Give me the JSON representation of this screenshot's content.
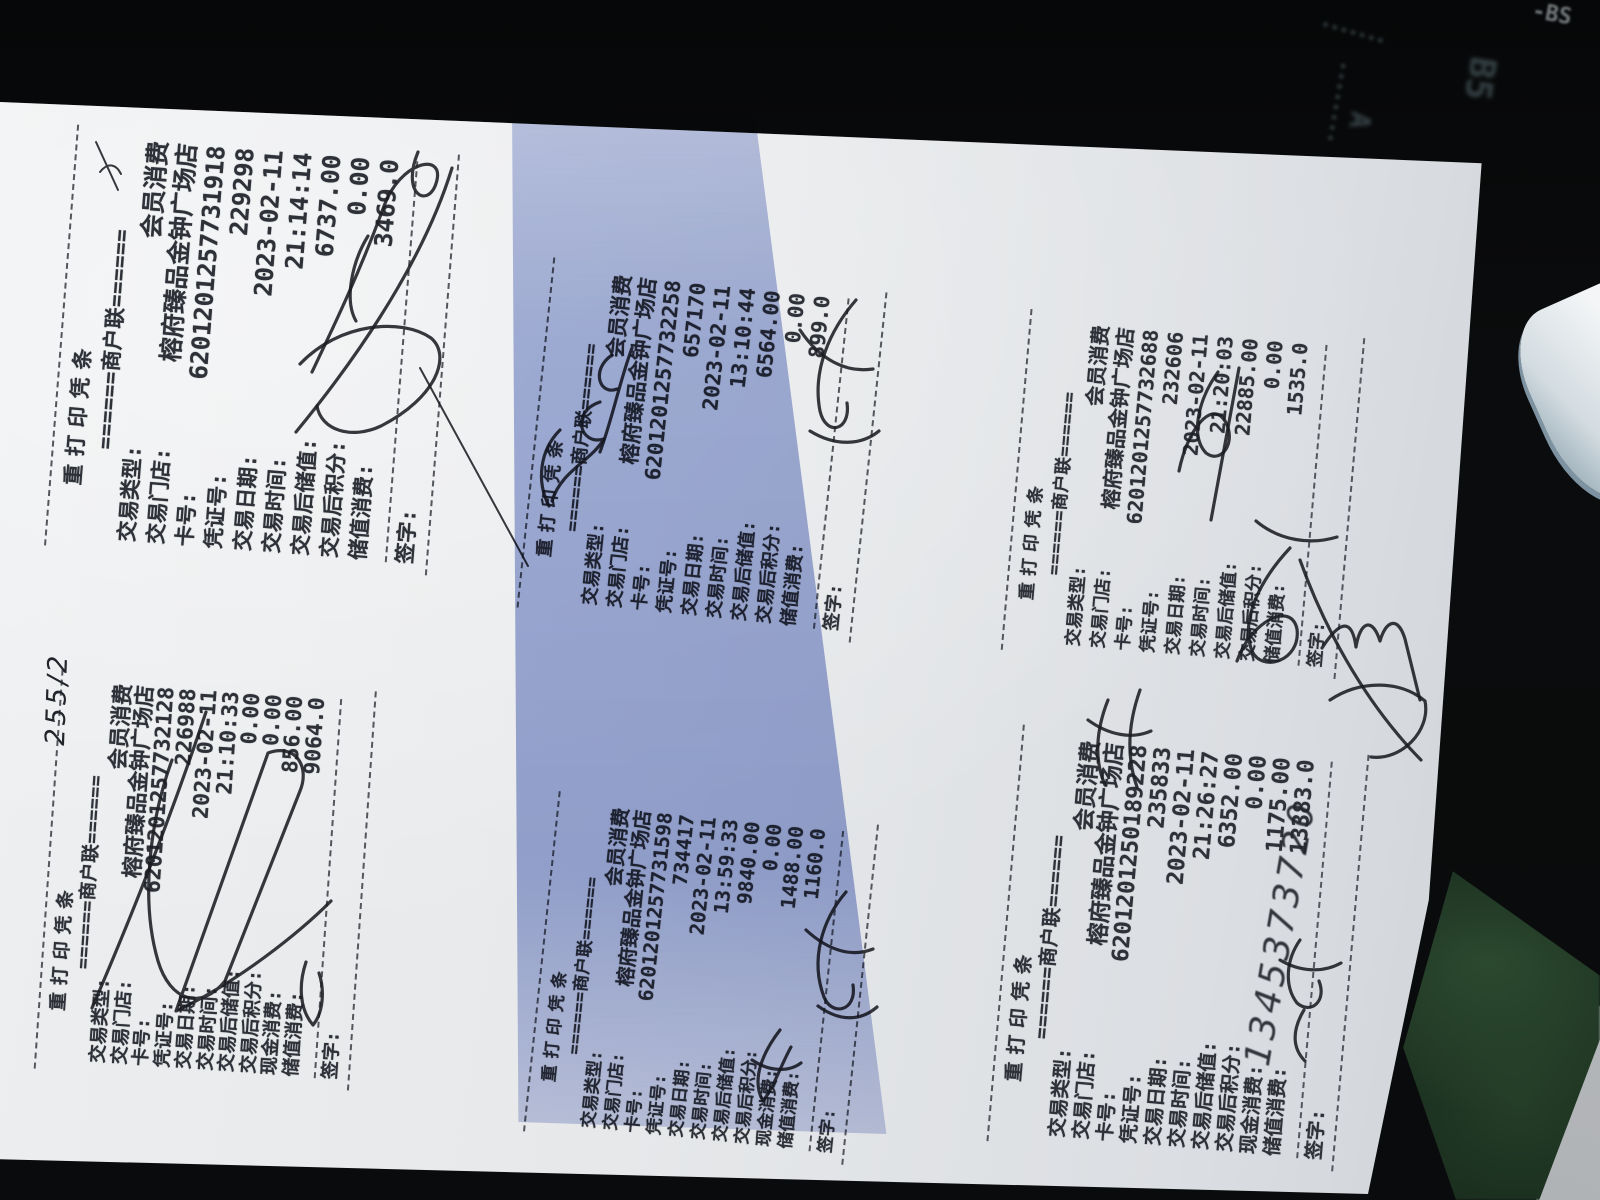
{
  "photo": {
    "background": {
      "mat_color": "#08090a",
      "mat_label_b5": "B5",
      "mat_label_a": "A",
      "mat_label_bs": "-BS",
      "shadow_band_color": "#9dabd8",
      "paper_color": "#e6e8ea"
    }
  },
  "receipt_common": {
    "title": "重打印凭条",
    "copy_line": "======商户联======",
    "sign_label": "签字:"
  },
  "receipts": [
    {
      "id": "top-left",
      "lines": [
        {
          "label": "交易类型:",
          "value": "会员消费"
        },
        {
          "label": "交易门店:",
          "value": "榕府臻品金钟广场店"
        },
        {
          "label": "卡号:",
          "value": "6201201257731918"
        },
        {
          "label": "凭证号:",
          "value": "229298"
        },
        {
          "label": "交易日期:",
          "value": "2023-02-11"
        },
        {
          "label": "交易时间:",
          "value": "21:14:14"
        },
        {
          "label": "交易后储值:",
          "value": "6737.00"
        },
        {
          "label": "交易后积分:",
          "value": "0.00"
        },
        {
          "label": "储值消费:",
          "value": "3469.0"
        }
      ]
    },
    {
      "id": "top-middle",
      "lines": [
        {
          "label": "交易类型:",
          "value": "会员消费"
        },
        {
          "label": "交易门店:",
          "value": "榕府臻品金钟广场店"
        },
        {
          "label": "卡号:",
          "value": "6201201257732258"
        },
        {
          "label": "凭证号:",
          "value": "657170"
        },
        {
          "label": "交易日期:",
          "value": "2023-02-11"
        },
        {
          "label": "交易时间:",
          "value": "13:10:44"
        },
        {
          "label": "交易后储值:",
          "value": "6564.00"
        },
        {
          "label": "交易后积分:",
          "value": "0.00"
        },
        {
          "label": "储值消费:",
          "value": "899.0"
        }
      ]
    },
    {
      "id": "top-right",
      "lines": [
        {
          "label": "交易类型:",
          "value": "会员消费"
        },
        {
          "label": "交易门店:",
          "value": "榕府臻品金钟广场店"
        },
        {
          "label": "卡号:",
          "value": "6201201257732688"
        },
        {
          "label": "凭证号:",
          "value": "232606"
        },
        {
          "label": "交易日期:",
          "value": "2023-02-11"
        },
        {
          "label": "交易时间:",
          "value": "21:20:03"
        },
        {
          "label": "交易后储值:",
          "value": "22885.00"
        },
        {
          "label": "交易后积分:",
          "value": "0.00"
        },
        {
          "label": "储值消费:",
          "value": "1535.0"
        }
      ]
    },
    {
      "id": "bottom-left",
      "lines": [
        {
          "label": "交易类型:",
          "value": "会员消费"
        },
        {
          "label": "交易门店:",
          "value": "榕府臻品金钟广场店"
        },
        {
          "label": "卡号:",
          "value": "6201201257732128"
        },
        {
          "label": "凭证号:",
          "value": "226988"
        },
        {
          "label": "交易日期:",
          "value": "2023-02-11"
        },
        {
          "label": "交易时间:",
          "value": "21:10:33"
        },
        {
          "label": "交易后储值:",
          "value": "0.00"
        },
        {
          "label": "交易后积分:",
          "value": "0.00"
        },
        {
          "label": "现金消费:",
          "value": "856.00"
        },
        {
          "label": "储值消费:",
          "value": "9064.0"
        }
      ]
    },
    {
      "id": "bottom-middle",
      "lines": [
        {
          "label": "交易类型:",
          "value": "会员消费"
        },
        {
          "label": "交易门店:",
          "value": "榕府臻品金钟广场店"
        },
        {
          "label": "卡号:",
          "value": "6201201257731598"
        },
        {
          "label": "凭证号:",
          "value": "734417"
        },
        {
          "label": "交易日期:",
          "value": "2023-02-11"
        },
        {
          "label": "交易时间:",
          "value": "13:59:33"
        },
        {
          "label": "交易后储值:",
          "value": "9840.00"
        },
        {
          "label": "交易后积分:",
          "value": "0.00"
        },
        {
          "label": "现金消费:",
          "value": "1488.00"
        },
        {
          "label": "储值消费:",
          "value": "1160.0"
        }
      ]
    },
    {
      "id": "bottom-right",
      "lines": [
        {
          "label": "交易类型:",
          "value": "会员消费"
        },
        {
          "label": "交易门店:",
          "value": "榕府臻品金钟广场店"
        },
        {
          "label": "卡号:",
          "value": "6201201250189228"
        },
        {
          "label": "凭证号:",
          "value": "235833"
        },
        {
          "label": "交易日期:",
          "value": "2023-02-11"
        },
        {
          "label": "交易时间:",
          "value": "21:26:27"
        },
        {
          "label": "交易后储值:",
          "value": "6352.00"
        },
        {
          "label": "交易后积分:",
          "value": "0.00"
        },
        {
          "label": "现金消费:",
          "value": "1175.00"
        },
        {
          "label": "储值消费:",
          "value": "13383.0"
        }
      ]
    }
  ],
  "handwriting": {
    "corner_note": "255/2",
    "receipt2_name_scrawl": "阿鸣汕",
    "receipt6_number_scrawl": "1345373720"
  }
}
